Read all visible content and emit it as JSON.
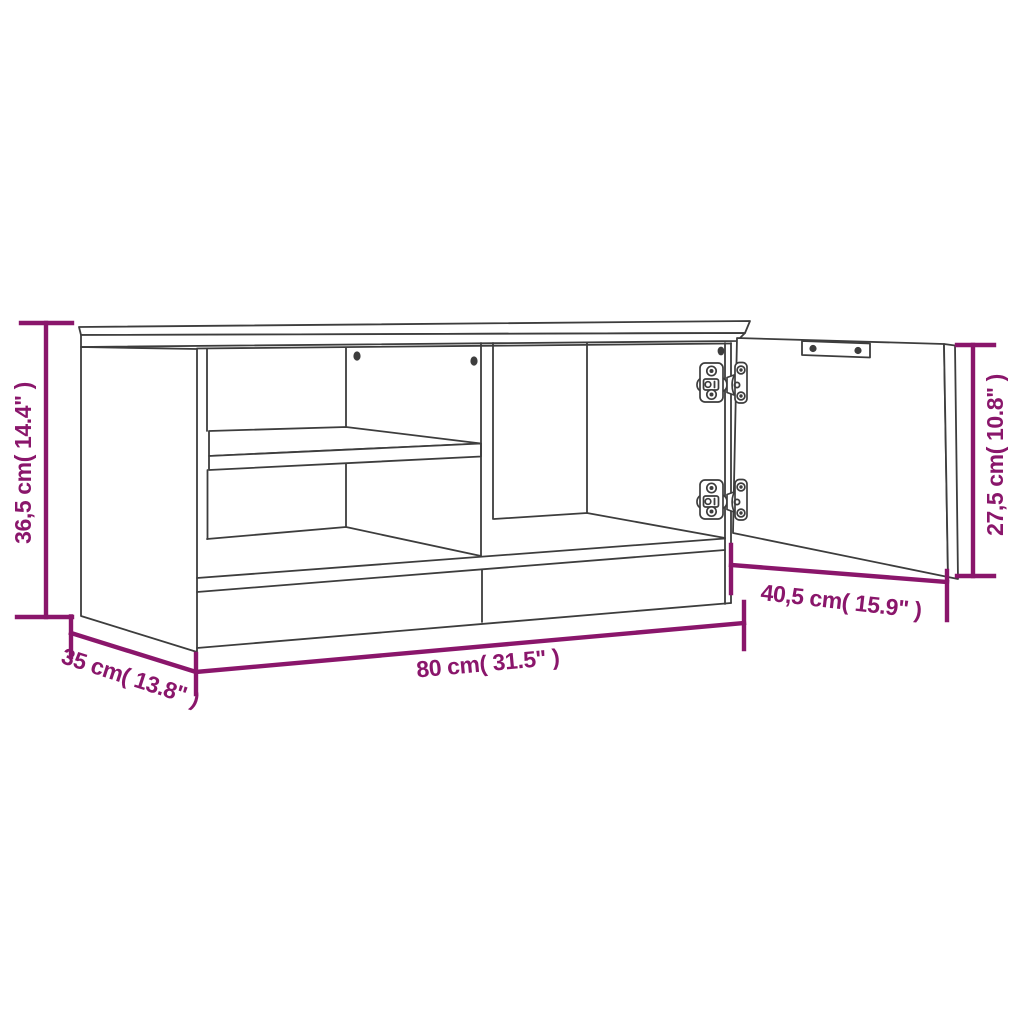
{
  "figure": {
    "type": "product-dimension-diagram",
    "subject": "TV cabinet line drawing with open door, two compartments, middle shelf and concealed hinges",
    "background_color": "#ffffff",
    "line_color": "#3d3d3d",
    "dimension_color": "#8a166b"
  },
  "dimensions": {
    "height": {
      "cm": "36,5",
      "inches": "14.4",
      "label": "36,5 cm( 14.4\" )"
    },
    "depth": {
      "cm": "35",
      "inches": "13.8",
      "label": "35 cm( 13.8\" )"
    },
    "width": {
      "cm": "80",
      "inches": "31.5",
      "label": "80 cm( 31.5\" )"
    },
    "door_width": {
      "cm": "40,5",
      "inches": "15.9",
      "label": "40,5 cm( 15.9\" )"
    },
    "door_height": {
      "cm": "27,5",
      "inches": "10.8",
      "label": "27,5 cm( 10.8\" )"
    }
  }
}
